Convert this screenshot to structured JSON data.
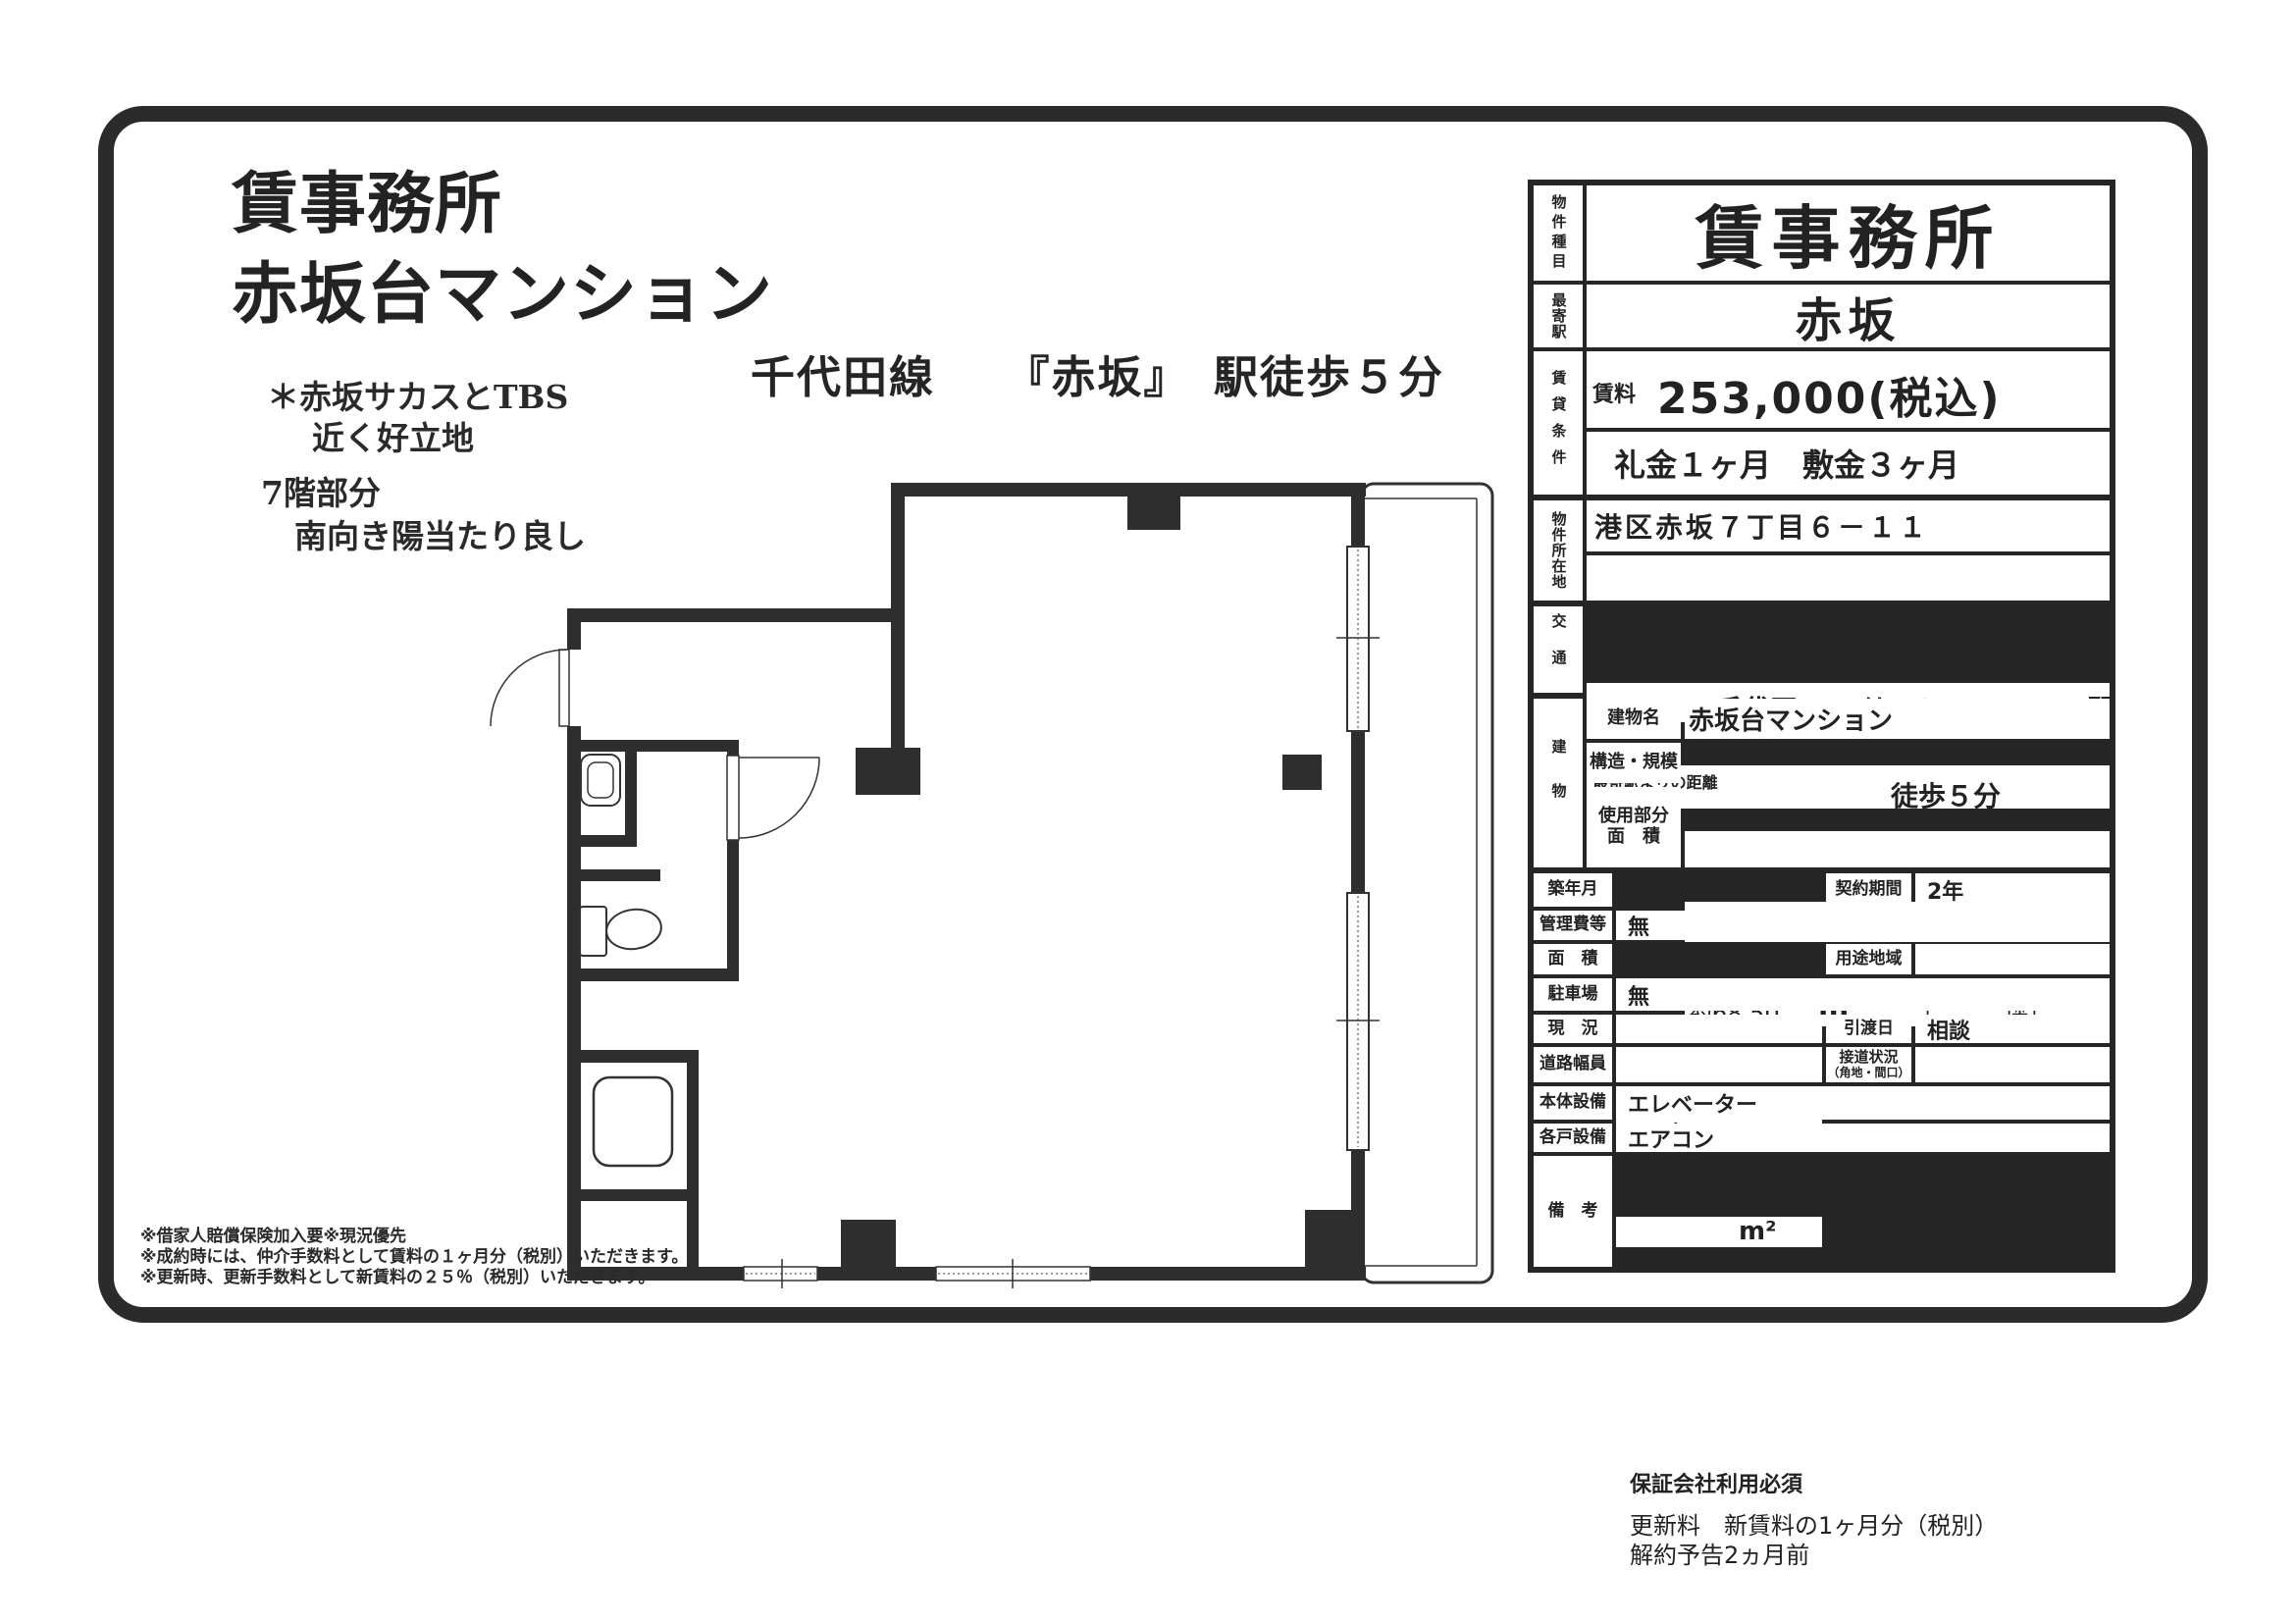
{
  "header": {
    "title_line1": "賃事務所",
    "title_line2": "赤坂台マンション",
    "note1_line1": "＊赤坂サカスとTBS",
    "note1_line2": "近く好立地",
    "note2_line1": "7階部分",
    "note2_line2": "南向き陽当たり良し",
    "station_heading": "千代田線　　『赤坂』　駅徒歩５分"
  },
  "disclaimers": [
    "※借家人賠償保険加入要※現況優先",
    "※成約時には、仲介手数料として賃料の１ヶ月分（税別）いただきます。",
    "※更新時、更新手数料として新賃料の２５％（税別）いただきます。"
  ],
  "table": {
    "property_type_label": "物件種目",
    "property_type": "賃事務所",
    "nearest_station_label": "最寄駅",
    "nearest_station": "赤坂",
    "terms_label": "賃貸条件",
    "rent_label": "賃料",
    "rent_value": "253,000(税込)",
    "rent_unit": "円",
    "key_money": "礼金１ヶ月　敷金３ヶ月",
    "location_label": "物件所在地",
    "location": "港区赤坂７丁目６－１１",
    "access_label": "交通",
    "line_name": "千代田",
    "line_suffix": "線",
    "access_station": "赤坂",
    "station_suffix": "駅",
    "distance_label": "最寄駅よりの距離",
    "distance_value": "徒歩５分",
    "building_label": "建物",
    "building_name_label": "建物名",
    "building_name": "赤坂台マンション",
    "structure_label": "構造・規模",
    "structure_value": "SRC造",
    "floors_total": "8",
    "floors_total_suffix": "階建",
    "floor_part": "7",
    "floor_part_suffix": "階部分",
    "area_label_1": "使用部分",
    "area_label_2": "面　積",
    "area_value": "約68.50",
    "area_unit": "m²",
    "area_tsubo": "（　　　坪）",
    "built_label": "築年月",
    "built_value": "年　月",
    "contract_label": "契約期間",
    "contract_value": "2年",
    "mgmt_label": "管理費等",
    "mgmt_value": "無",
    "area2_label": "面　積",
    "area2_unit": "m²",
    "zoning_label": "用途地域",
    "zoning_value": "",
    "parking_label": "駐車場",
    "parking_value": "無",
    "status_label": "現　況",
    "status_value": "",
    "handover_label": "引渡日",
    "handover_value": "相談",
    "road_label": "道路幅員",
    "road_value": "",
    "road_contact_label_1": "接道状況",
    "road_contact_label_2": "（角地・間口）",
    "road_contact_value": "",
    "bldg_equip_label": "本体設備",
    "bldg_equip_value": "エレベーター",
    "unit_equip_label": "各戸設備",
    "unit_equip_value": "エアコン",
    "remarks_label": "備　考",
    "remarks_line1": "保証会社利用必須",
    "remarks_line2": "更新料　新賃料の1ヶ月分（税別）",
    "remarks_line3": "解約予告2ヵ月前"
  }
}
